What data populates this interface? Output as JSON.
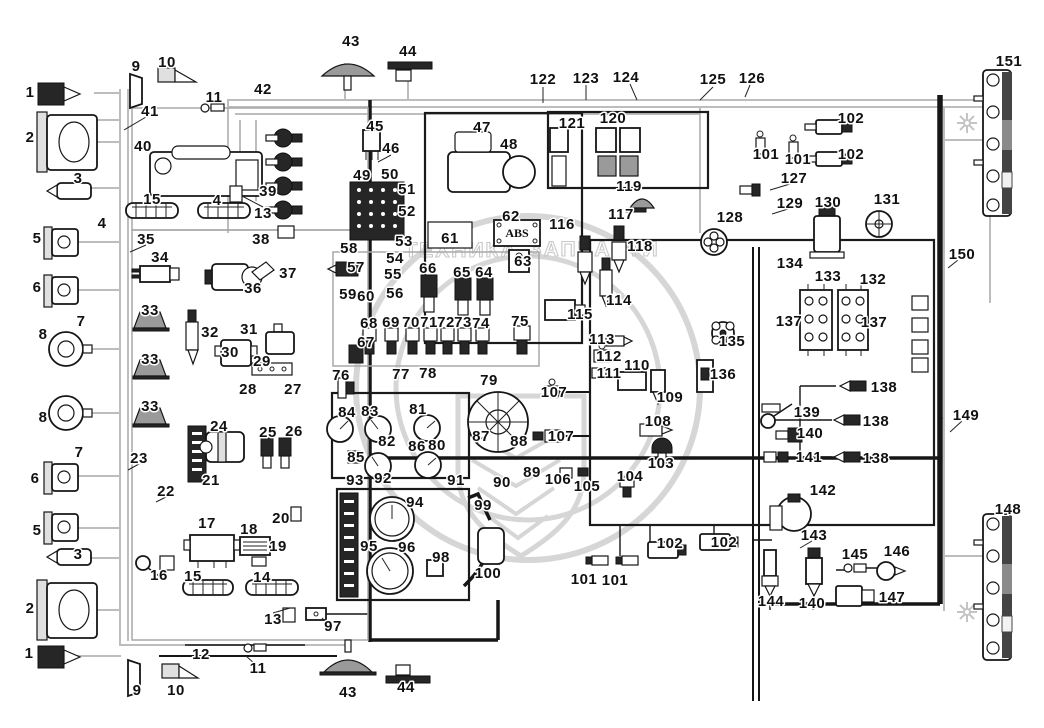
{
  "watermark": {
    "left_word": "ТЕХНИКА",
    "right_word": "ЗАПЧАСТИ"
  },
  "abs_box_label": "ABS",
  "callouts": [
    {
      "t": "1",
      "x": 30,
      "y": 92
    },
    {
      "t": "2",
      "x": 30,
      "y": 137
    },
    {
      "t": "3",
      "x": 78,
      "y": 178
    },
    {
      "t": "4",
      "x": 102,
      "y": 223
    },
    {
      "t": "5",
      "x": 37,
      "y": 238
    },
    {
      "t": "6",
      "x": 37,
      "y": 287
    },
    {
      "t": "7",
      "x": 81,
      "y": 321
    },
    {
      "t": "8",
      "x": 43,
      "y": 334
    },
    {
      "t": "8",
      "x": 43,
      "y": 417
    },
    {
      "t": "7",
      "x": 79,
      "y": 452
    },
    {
      "t": "6",
      "x": 35,
      "y": 478
    },
    {
      "t": "5",
      "x": 37,
      "y": 530
    },
    {
      "t": "3",
      "x": 78,
      "y": 554
    },
    {
      "t": "2",
      "x": 30,
      "y": 608
    },
    {
      "t": "1",
      "x": 29,
      "y": 653
    },
    {
      "t": "9",
      "x": 136,
      "y": 66
    },
    {
      "t": "10",
      "x": 167,
      "y": 62
    },
    {
      "t": "11",
      "x": 214,
      "y": 97
    },
    {
      "t": "41",
      "x": 150,
      "y": 111
    },
    {
      "t": "40",
      "x": 143,
      "y": 146
    },
    {
      "t": "42",
      "x": 263,
      "y": 89
    },
    {
      "t": "15",
      "x": 152,
      "y": 199
    },
    {
      "t": "4",
      "x": 217,
      "y": 200
    },
    {
      "t": "13",
      "x": 263,
      "y": 213
    },
    {
      "t": "39",
      "x": 268,
      "y": 191
    },
    {
      "t": "38",
      "x": 261,
      "y": 239
    },
    {
      "t": "35",
      "x": 146,
      "y": 239
    },
    {
      "t": "34",
      "x": 160,
      "y": 257
    },
    {
      "t": "36",
      "x": 253,
      "y": 288
    },
    {
      "t": "37",
      "x": 288,
      "y": 273
    },
    {
      "t": "33",
      "x": 150,
      "y": 310
    },
    {
      "t": "32",
      "x": 210,
      "y": 332
    },
    {
      "t": "31",
      "x": 249,
      "y": 329
    },
    {
      "t": "30",
      "x": 230,
      "y": 352
    },
    {
      "t": "29",
      "x": 262,
      "y": 361
    },
    {
      "t": "33",
      "x": 150,
      "y": 359
    },
    {
      "t": "28",
      "x": 248,
      "y": 389
    },
    {
      "t": "27",
      "x": 293,
      "y": 389
    },
    {
      "t": "33",
      "x": 150,
      "y": 406
    },
    {
      "t": "24",
      "x": 219,
      "y": 426
    },
    {
      "t": "25",
      "x": 268,
      "y": 432
    },
    {
      "t": "26",
      "x": 294,
      "y": 431
    },
    {
      "t": "23",
      "x": 139,
      "y": 458
    },
    {
      "t": "22",
      "x": 166,
      "y": 491
    },
    {
      "t": "21",
      "x": 211,
      "y": 480
    },
    {
      "t": "17",
      "x": 207,
      "y": 523
    },
    {
      "t": "18",
      "x": 249,
      "y": 529
    },
    {
      "t": "19",
      "x": 278,
      "y": 546
    },
    {
      "t": "20",
      "x": 281,
      "y": 518
    },
    {
      "t": "16",
      "x": 159,
      "y": 575
    },
    {
      "t": "15",
      "x": 193,
      "y": 576
    },
    {
      "t": "14",
      "x": 262,
      "y": 577
    },
    {
      "t": "13",
      "x": 273,
      "y": 619
    },
    {
      "t": "97",
      "x": 333,
      "y": 626
    },
    {
      "t": "12",
      "x": 201,
      "y": 654
    },
    {
      "t": "11",
      "x": 258,
      "y": 668
    },
    {
      "t": "9",
      "x": 137,
      "y": 690
    },
    {
      "t": "10",
      "x": 176,
      "y": 690
    },
    {
      "t": "43",
      "x": 348,
      "y": 692
    },
    {
      "t": "44",
      "x": 406,
      "y": 687
    },
    {
      "t": "43",
      "x": 351,
      "y": 41
    },
    {
      "t": "44",
      "x": 408,
      "y": 51
    },
    {
      "t": "45",
      "x": 375,
      "y": 126
    },
    {
      "t": "46",
      "x": 391,
      "y": 148
    },
    {
      "t": "47",
      "x": 482,
      "y": 127
    },
    {
      "t": "48",
      "x": 509,
      "y": 144
    },
    {
      "t": "49",
      "x": 362,
      "y": 175
    },
    {
      "t": "50",
      "x": 390,
      "y": 174
    },
    {
      "t": "51",
      "x": 407,
      "y": 189
    },
    {
      "t": "52",
      "x": 407,
      "y": 211
    },
    {
      "t": "53",
      "x": 404,
      "y": 241
    },
    {
      "t": "58",
      "x": 349,
      "y": 248
    },
    {
      "t": "54",
      "x": 395,
      "y": 258
    },
    {
      "t": "57",
      "x": 356,
      "y": 267
    },
    {
      "t": "55",
      "x": 393,
      "y": 274
    },
    {
      "t": "56",
      "x": 395,
      "y": 293
    },
    {
      "t": "59",
      "x": 348,
      "y": 294
    },
    {
      "t": "60",
      "x": 366,
      "y": 296
    },
    {
      "t": "61",
      "x": 450,
      "y": 238
    },
    {
      "t": "62",
      "x": 511,
      "y": 216
    },
    {
      "t": "63",
      "x": 523,
      "y": 261
    },
    {
      "t": "66",
      "x": 428,
      "y": 268
    },
    {
      "t": "65",
      "x": 462,
      "y": 272
    },
    {
      "t": "64",
      "x": 484,
      "y": 272
    },
    {
      "t": "122",
      "x": 543,
      "y": 79
    },
    {
      "t": "123",
      "x": 586,
      "y": 78
    },
    {
      "t": "124",
      "x": 626,
      "y": 77
    },
    {
      "t": "121",
      "x": 572,
      "y": 123
    },
    {
      "t": "120",
      "x": 613,
      "y": 118
    },
    {
      "t": "119",
      "x": 629,
      "y": 186
    },
    {
      "t": "116",
      "x": 562,
      "y": 224
    },
    {
      "t": "117",
      "x": 621,
      "y": 214
    },
    {
      "t": "118",
      "x": 640,
      "y": 246
    },
    {
      "t": "125",
      "x": 713,
      "y": 79
    },
    {
      "t": "126",
      "x": 752,
      "y": 78
    },
    {
      "t": "101",
      "x": 766,
      "y": 154
    },
    {
      "t": "101",
      "x": 798,
      "y": 159
    },
    {
      "t": "102",
      "x": 851,
      "y": 118
    },
    {
      "t": "102",
      "x": 851,
      "y": 154
    },
    {
      "t": "127",
      "x": 794,
      "y": 178
    },
    {
      "t": "129",
      "x": 790,
      "y": 203
    },
    {
      "t": "130",
      "x": 828,
      "y": 202
    },
    {
      "t": "131",
      "x": 887,
      "y": 199
    },
    {
      "t": "128",
      "x": 730,
      "y": 217
    },
    {
      "t": "151",
      "x": 1009,
      "y": 61
    },
    {
      "t": "150",
      "x": 962,
      "y": 254
    },
    {
      "t": "68",
      "x": 369,
      "y": 323
    },
    {
      "t": "69",
      "x": 391,
      "y": 322
    },
    {
      "t": "70",
      "x": 411,
      "y": 322
    },
    {
      "t": "71",
      "x": 429,
      "y": 322
    },
    {
      "t": "72",
      "x": 446,
      "y": 322
    },
    {
      "t": "73",
      "x": 463,
      "y": 322
    },
    {
      "t": "74",
      "x": 481,
      "y": 323
    },
    {
      "t": "75",
      "x": 520,
      "y": 321
    },
    {
      "t": "67",
      "x": 366,
      "y": 342
    },
    {
      "t": "76",
      "x": 341,
      "y": 375
    },
    {
      "t": "77",
      "x": 401,
      "y": 374
    },
    {
      "t": "78",
      "x": 428,
      "y": 373
    },
    {
      "t": "79",
      "x": 489,
      "y": 380
    },
    {
      "t": "114",
      "x": 619,
      "y": 300
    },
    {
      "t": "115",
      "x": 580,
      "y": 314
    },
    {
      "t": "113",
      "x": 602,
      "y": 339
    },
    {
      "t": "112",
      "x": 609,
      "y": 356
    },
    {
      "t": "111",
      "x": 609,
      "y": 373
    },
    {
      "t": "110",
      "x": 637,
      "y": 365
    },
    {
      "t": "109",
      "x": 670,
      "y": 397
    },
    {
      "t": "107",
      "x": 554,
      "y": 392
    },
    {
      "t": "107",
      "x": 561,
      "y": 436
    },
    {
      "t": "108",
      "x": 658,
      "y": 421
    },
    {
      "t": "134",
      "x": 790,
      "y": 263
    },
    {
      "t": "133",
      "x": 828,
      "y": 276
    },
    {
      "t": "132",
      "x": 873,
      "y": 279
    },
    {
      "t": "137",
      "x": 789,
      "y": 321
    },
    {
      "t": "137",
      "x": 874,
      "y": 322
    },
    {
      "t": "135",
      "x": 732,
      "y": 341
    },
    {
      "t": "136",
      "x": 723,
      "y": 374
    },
    {
      "t": "138",
      "x": 884,
      "y": 387
    },
    {
      "t": "138",
      "x": 876,
      "y": 421
    },
    {
      "t": "138",
      "x": 876,
      "y": 458
    },
    {
      "t": "139",
      "x": 807,
      "y": 412
    },
    {
      "t": "140",
      "x": 810,
      "y": 433
    },
    {
      "t": "141",
      "x": 809,
      "y": 457
    },
    {
      "t": "149",
      "x": 966,
      "y": 415
    },
    {
      "t": "84",
      "x": 347,
      "y": 412
    },
    {
      "t": "83",
      "x": 370,
      "y": 411
    },
    {
      "t": "81",
      "x": 418,
      "y": 409
    },
    {
      "t": "82",
      "x": 387,
      "y": 441
    },
    {
      "t": "86",
      "x": 417,
      "y": 446
    },
    {
      "t": "80",
      "x": 437,
      "y": 445
    },
    {
      "t": "85",
      "x": 356,
      "y": 457
    },
    {
      "t": "87",
      "x": 481,
      "y": 436
    },
    {
      "t": "88",
      "x": 519,
      "y": 441
    },
    {
      "t": "89",
      "x": 532,
      "y": 472
    },
    {
      "t": "90",
      "x": 502,
      "y": 482
    },
    {
      "t": "91",
      "x": 456,
      "y": 480
    },
    {
      "t": "92",
      "x": 383,
      "y": 478
    },
    {
      "t": "93",
      "x": 355,
      "y": 480
    },
    {
      "t": "103",
      "x": 661,
      "y": 463
    },
    {
      "t": "104",
      "x": 630,
      "y": 476
    },
    {
      "t": "105",
      "x": 587,
      "y": 486
    },
    {
      "t": "106",
      "x": 558,
      "y": 479
    },
    {
      "t": "94",
      "x": 415,
      "y": 502
    },
    {
      "t": "95",
      "x": 369,
      "y": 546
    },
    {
      "t": "96",
      "x": 407,
      "y": 547
    },
    {
      "t": "98",
      "x": 441,
      "y": 557
    },
    {
      "t": "99",
      "x": 483,
      "y": 505
    },
    {
      "t": "100",
      "x": 488,
      "y": 573
    },
    {
      "t": "101",
      "x": 584,
      "y": 579
    },
    {
      "t": "101",
      "x": 615,
      "y": 580
    },
    {
      "t": "102",
      "x": 670,
      "y": 543
    },
    {
      "t": "102",
      "x": 724,
      "y": 542
    },
    {
      "t": "142",
      "x": 823,
      "y": 490
    },
    {
      "t": "143",
      "x": 814,
      "y": 535
    },
    {
      "t": "144",
      "x": 771,
      "y": 601
    },
    {
      "t": "140",
      "x": 812,
      "y": 603
    },
    {
      "t": "145",
      "x": 855,
      "y": 554
    },
    {
      "t": "146",
      "x": 897,
      "y": 551
    },
    {
      "t": "147",
      "x": 892,
      "y": 597
    },
    {
      "t": "148",
      "x": 1008,
      "y": 509
    }
  ]
}
